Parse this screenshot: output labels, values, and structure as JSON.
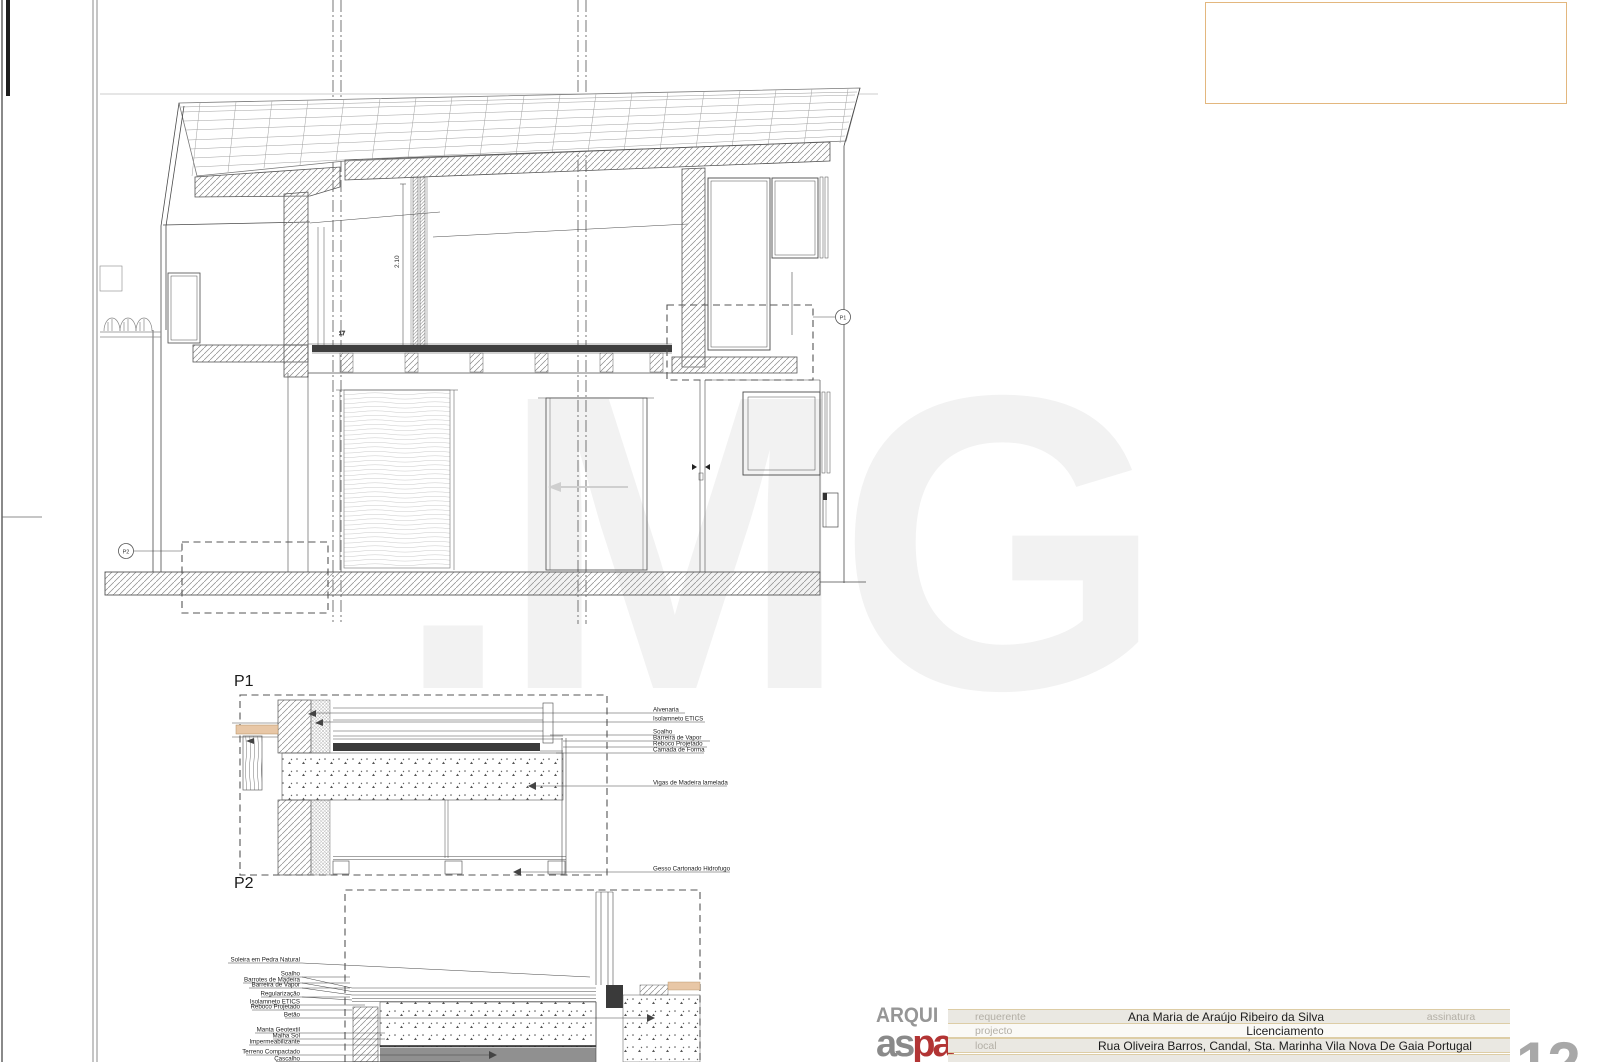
{
  "page": {
    "number": "12"
  },
  "section": {
    "callouts": {
      "p1": "P1",
      "p2": "P2"
    },
    "dims": {
      "height": "2.10",
      "small": "17"
    }
  },
  "watermark": {
    "text": ".MG"
  },
  "p1_detail": {
    "labels": [
      "Alvenaria",
      "Isolamneto ETICS",
      "Soalho",
      "Barreira de Vapor",
      "Reboco Projetado",
      "Camada de Forma",
      "Vigas de Madeira lamelada",
      "Gesso Cartonado Hidrofugo"
    ]
  },
  "p2_detail": {
    "labels": [
      "Soleira em Pedra Natural",
      "Soalho",
      "Barrotes de Madeira",
      "Barreira de Vapor",
      "Regularização",
      "Isolamneto ETICS",
      "Reboco Projetado",
      "Betão",
      "Manta Geotextil",
      "Malha Sol",
      "Impermeabilizante",
      "Terreno Compactado",
      "Cascalho"
    ]
  },
  "title_block": {
    "logo_top": "ARQUI",
    "logo_gray": "as",
    "logo_red": "pa",
    "rows": [
      {
        "label": "requerente",
        "value": "Ana Maria de Araújo Ribeiro da Silva",
        "extra": "assinatura"
      },
      {
        "label": "projecto",
        "value": "Licenciamento"
      },
      {
        "label": "local",
        "value": "Rua Oliveira Barros, Candal, Sta. Marinha Vila Nova De Gaia Portugal"
      }
    ]
  },
  "colors": {
    "accent_tan": "#e3b77e",
    "logo_red": "#b23434",
    "hatch": "#8a8a8a",
    "dark_fill": "#3a3a3a",
    "wood_tan": "#e8c7a6"
  }
}
